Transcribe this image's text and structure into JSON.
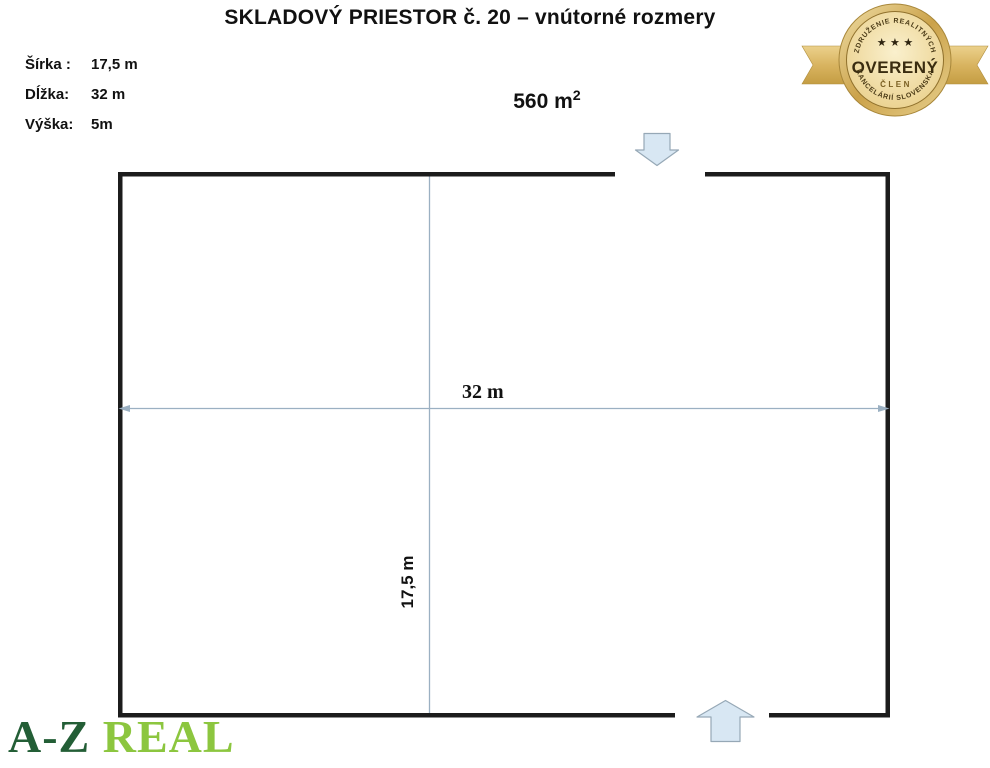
{
  "title": "SKLADOVÝ PRIESTOR č. 20 – vnútorné rozmery",
  "dimensions": {
    "items": [
      {
        "label": "Šírka :",
        "value": "17,5 m"
      },
      {
        "label": "Dĺžka:",
        "value": "32 m"
      },
      {
        "label": "Výška:",
        "value": "5m"
      }
    ]
  },
  "area": {
    "value": "560 m",
    "sup": "2"
  },
  "plan": {
    "width_label": "32 m",
    "height_label": "17,5 m"
  },
  "badge": {
    "arc_top": "ZDRUŽENIE REALITNÝCH",
    "arc_bottom": "KANCELÁRIÍ SLOVENSKA",
    "stars": "★ ★ ★",
    "main": "OVERENÝ",
    "sub": "ČLEN"
  },
  "logo": {
    "primary": "A-Z",
    "secondary": "REAL"
  },
  "colors": {
    "logo-dark": "#235e36",
    "logo-light": "#8cc63f",
    "wall": "#1c1c1c",
    "dim-line": "#9bb0c2",
    "arrow-fill": "#d8e7f3",
    "arrow-stroke": "#96a8b6",
    "badge-text": "#3a2c10"
  }
}
